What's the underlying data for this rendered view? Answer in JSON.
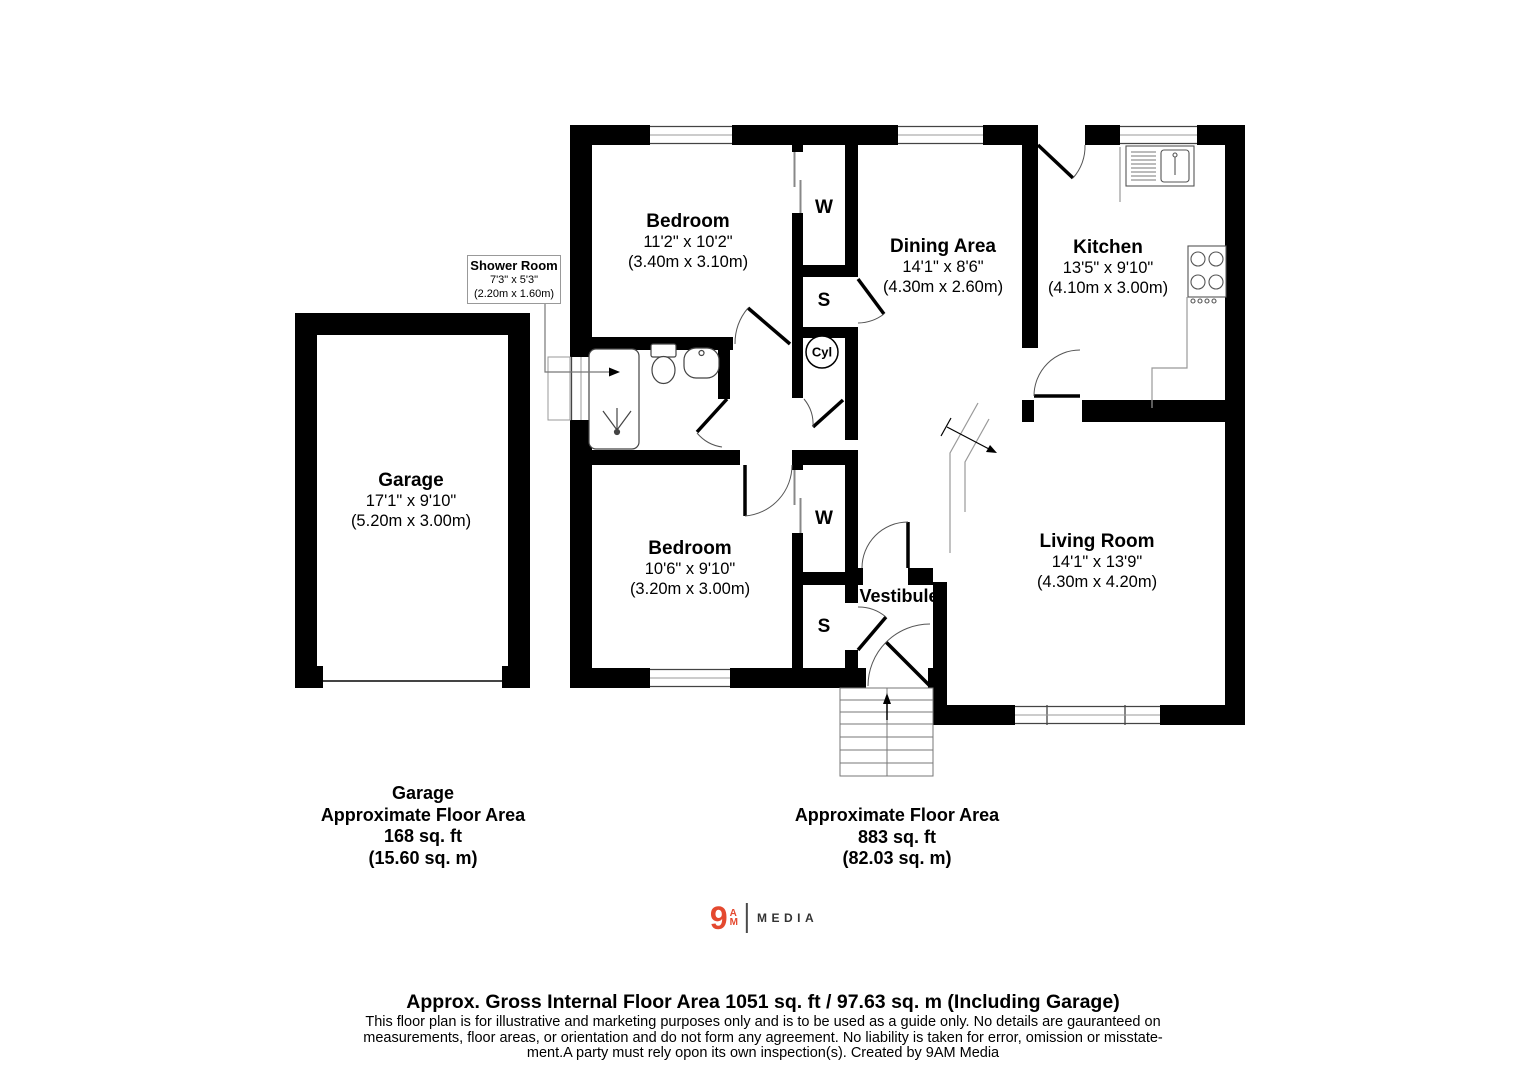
{
  "plan": {
    "rooms": [
      {
        "name": "Bedroom",
        "dims_imperial": "11'2\" x 10'2\"",
        "dims_metric": "(3.40m x 3.10m)"
      },
      {
        "name": "Dining Area",
        "dims_imperial": "14'1\" x 8'6\"",
        "dims_metric": "(4.30m x 2.60m)"
      },
      {
        "name": "Kitchen",
        "dims_imperial": "13'5\" x 9'10\"",
        "dims_metric": "(4.10m x 3.00m)"
      },
      {
        "name": "Shower Room",
        "dims_imperial": "7'3\" x 5'3\"",
        "dims_metric": "(2.20m x 1.60m)"
      },
      {
        "name": "Garage",
        "dims_imperial": "17'1\" x 9'10\"",
        "dims_metric": "(5.20m x 3.00m)"
      },
      {
        "name": "Bedroom",
        "dims_imperial": "10'6\" x 9'10\"",
        "dims_metric": "(3.20m x 3.00m)"
      },
      {
        "name": "Living Room",
        "dims_imperial": "14'1\" x 13'9\"",
        "dims_metric": "(4.30m x 4.20m)"
      },
      {
        "name": "Vestibule"
      }
    ],
    "markers": {
      "wardrobe": "W",
      "store": "S",
      "cylinder": "Cyl"
    }
  },
  "area_summary": {
    "garage": {
      "title": "Garage",
      "line1": "Approximate Floor Area",
      "line2": "168 sq. ft",
      "line3": "(15.60 sq. m)"
    },
    "house": {
      "line1": "Approximate Floor Area",
      "line2": "883 sq. ft",
      "line3": "(82.03 sq. m)"
    }
  },
  "logo": {
    "nine": "9",
    "a": "A",
    "m": "M",
    "media": "MEDIA",
    "accent_color": "#E4492F"
  },
  "footer": {
    "title": "Approx. Gross Internal Floor Area 1051 sq. ft / 97.63 sq. m (Including Garage)",
    "disclaimer_line1": "This floor plan is for illustrative and marketing purposes only and is to be used as a guide only. No details are gauranteed on",
    "disclaimer_line2": "measurements, floor areas, or orientation and do not form any agreement. No liability is taken for error, omission or misstate-",
    "disclaimer_line3": "ment.A party must rely opon its own inspection(s). Created by 9AM Media"
  },
  "colors": {
    "wall": "#000000",
    "glaze": "#999999",
    "fixture": "#444444"
  }
}
